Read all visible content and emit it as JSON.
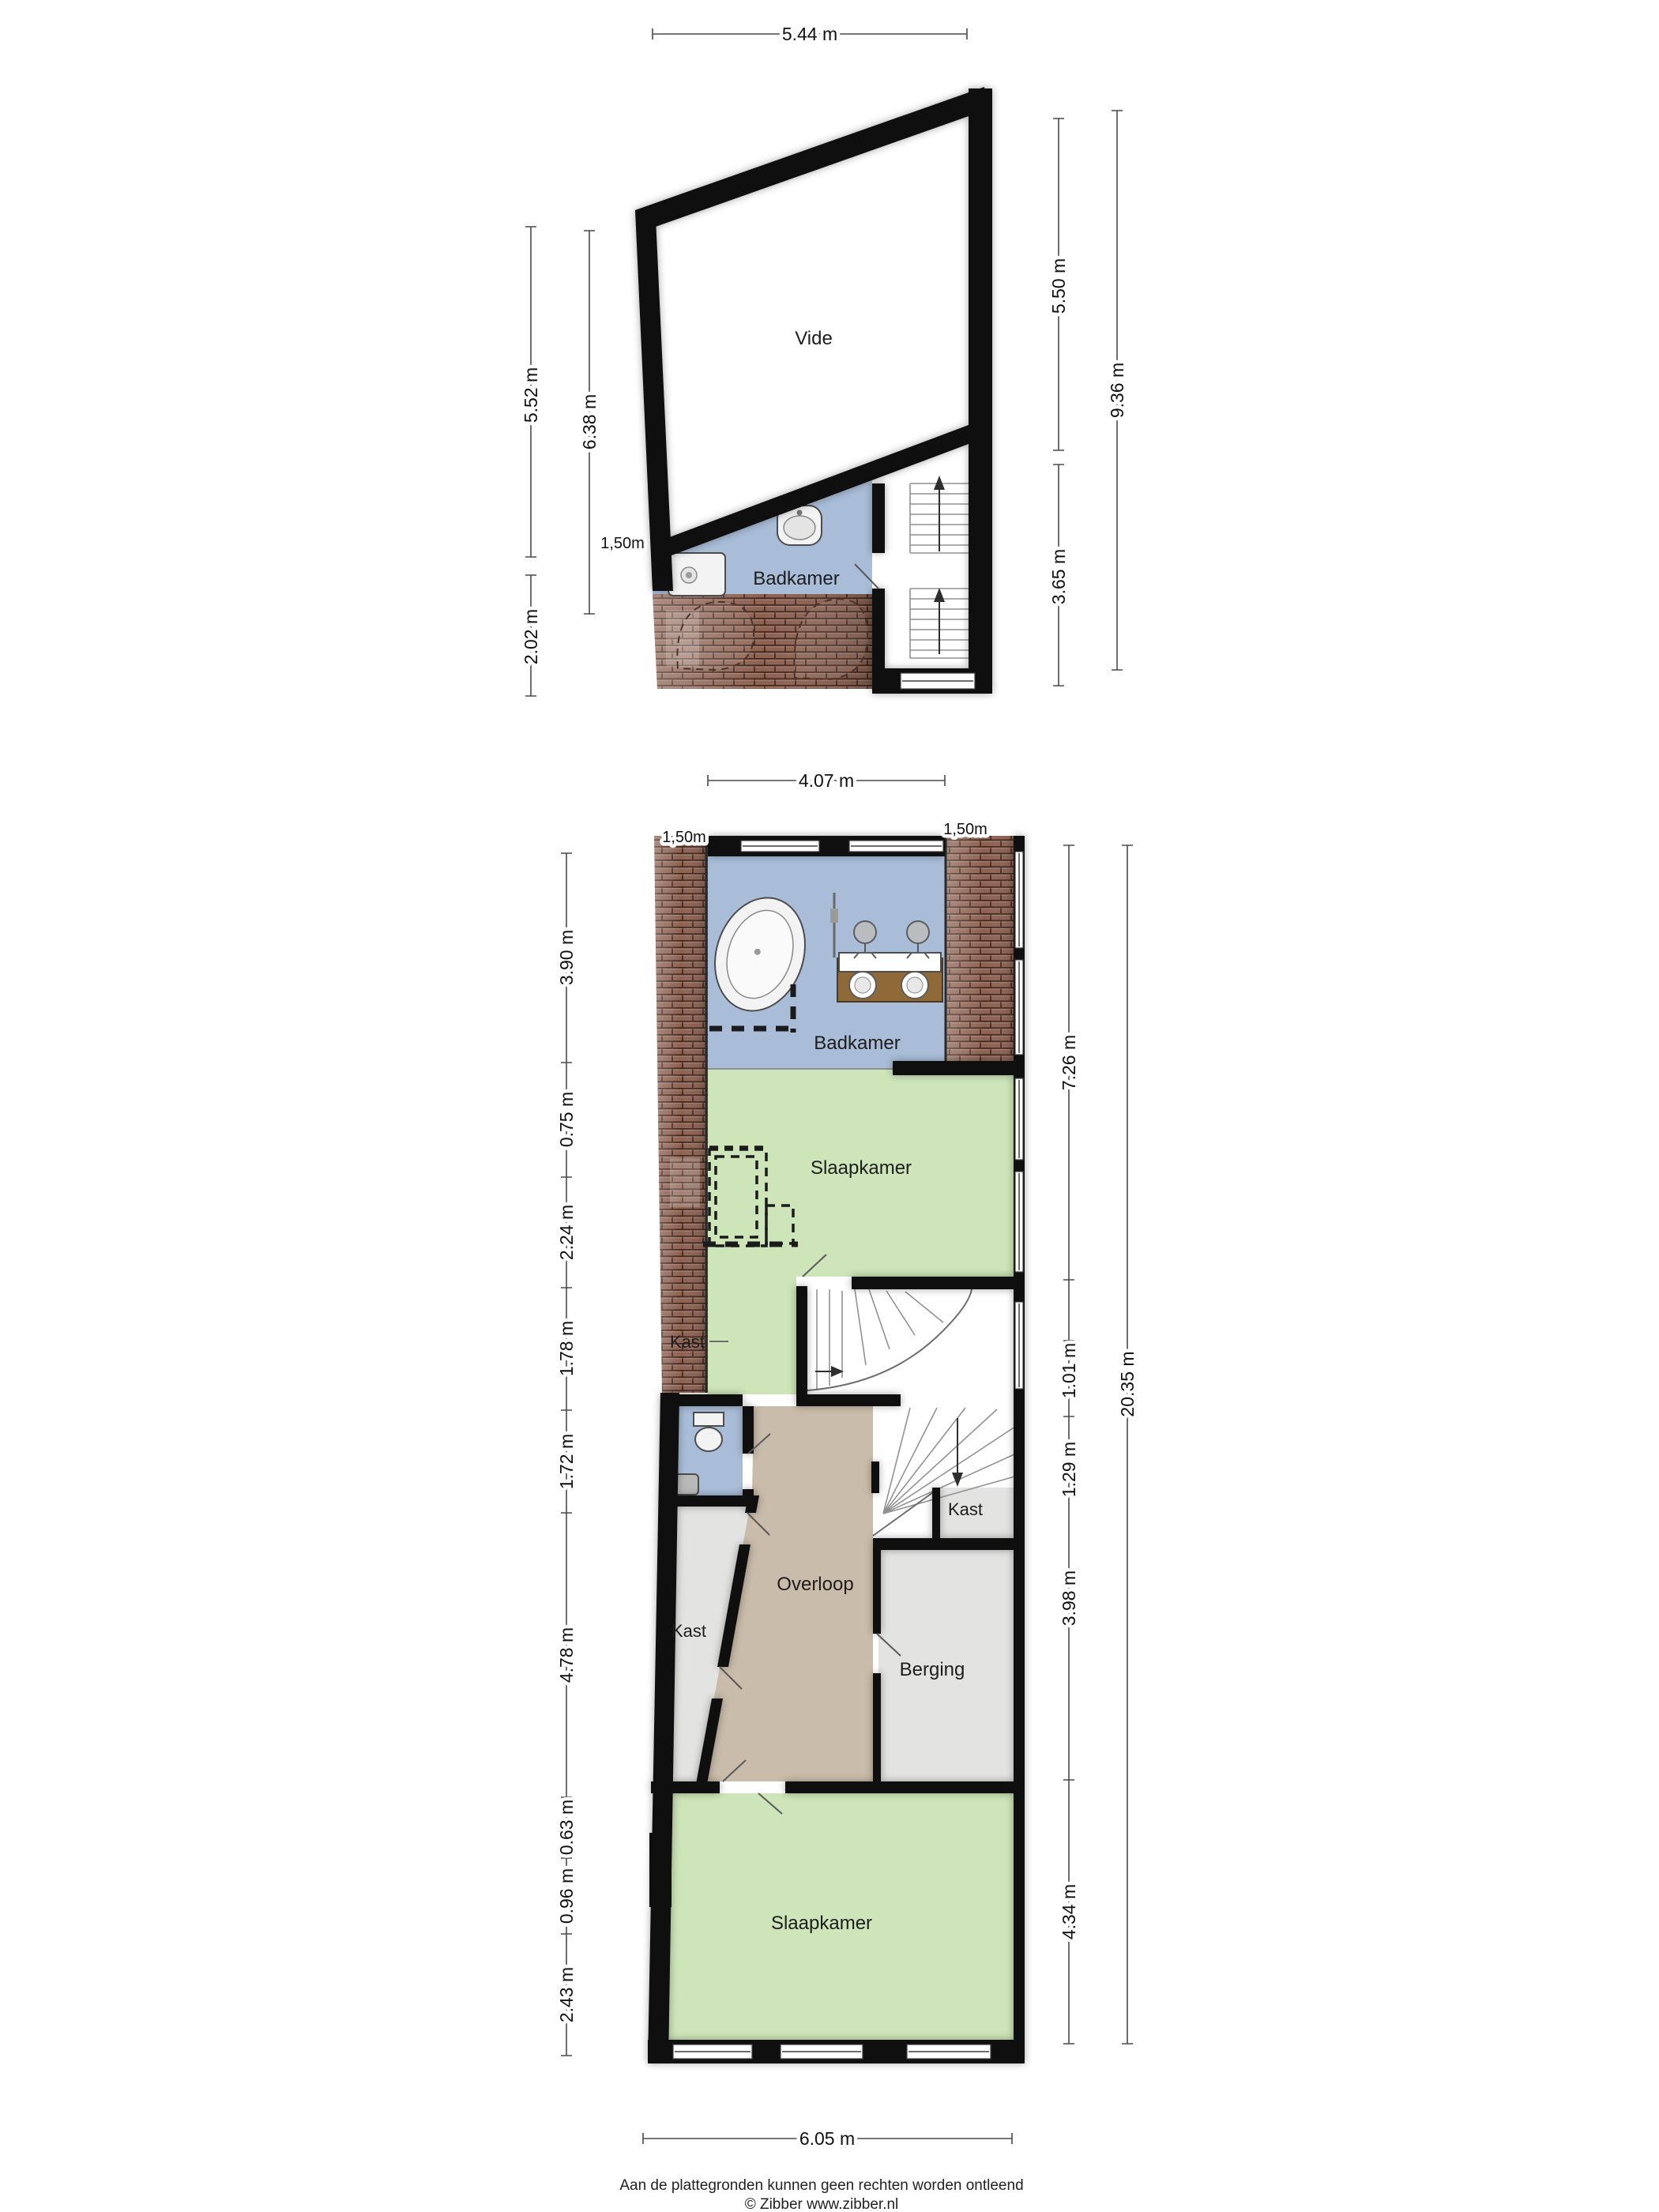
{
  "upper_plan": {
    "rooms": {
      "vide": "Vide",
      "badkamer": "Badkamer"
    },
    "dims": {
      "top": "5.44 m",
      "left_inner": "5.52 m",
      "left_lower": "2.02 m",
      "left_outer": "6.38 m",
      "right_upper": "5.50 m",
      "right_lower": "3.65 m",
      "right_total": "9.36 m",
      "roof": "1,50m"
    }
  },
  "lower_plan": {
    "rooms": {
      "badkamer": "Badkamer",
      "slaapkamer_boven": "Slaapkamer",
      "kast_strip": "Kast",
      "kast_links": "Kast",
      "kast_rechts": "Kast",
      "overloop": "Overloop",
      "berging": "Berging",
      "slaapkamer_onder": "Slaapkamer"
    },
    "dims": {
      "top": "4.07 m",
      "roof_left": "1,50m",
      "roof_right": "1,50m",
      "left": [
        "3.90 m",
        "0.75 m",
        "2.24 m",
        "1.78 m",
        "1.72 m",
        "4.78 m",
        "0.63 m",
        "0.96 m",
        "2.43 m"
      ],
      "right": [
        "7.26 m",
        "1.01 m",
        "1.29 m",
        "3.98 m",
        "4.34 m"
      ],
      "right_total": "20.35 m",
      "bottom": "6.05 m"
    }
  },
  "footer": {
    "line1": "Aan de plattegronden kunnen geen rechten worden ontleend",
    "line2": "© Zibber www.zibber.nl"
  },
  "colors": {
    "wall": "#0f0f0f",
    "bathroom_blue": "#a9bdd8",
    "bedroom_green": "#cde5b9",
    "hall_tan": "#cabcaa",
    "closet_gray": "#e3e3e2",
    "roof_tile": "#8d6150"
  }
}
